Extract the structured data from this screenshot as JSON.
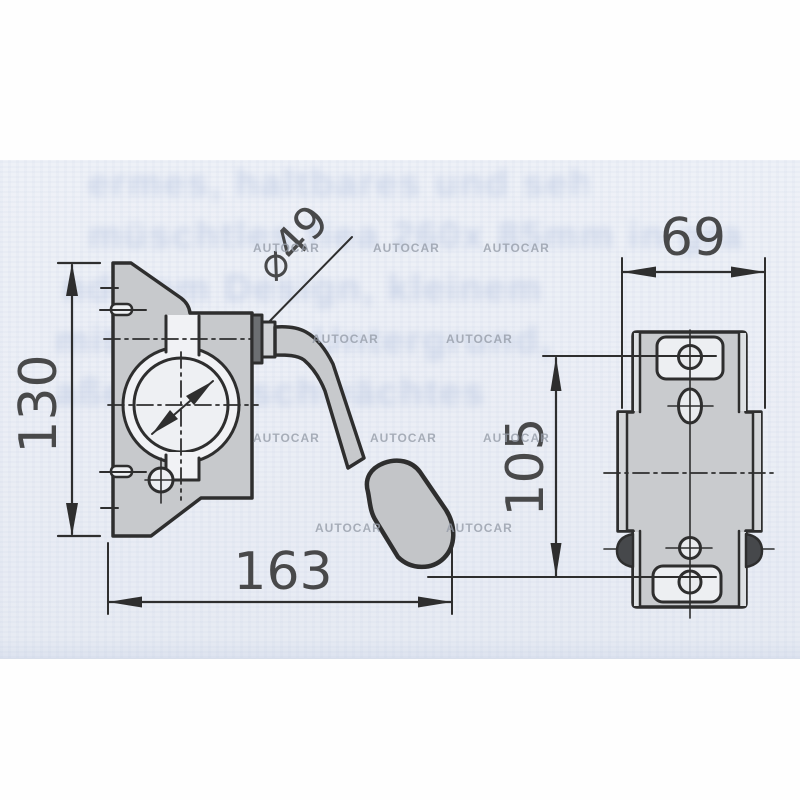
{
  "dims": {
    "left_height": "130",
    "bottom_width": "163",
    "clamp_diameter": "⌀49",
    "right_width": "69",
    "right_hole_spacing": "105"
  },
  "watermark": {
    "label": "AUTOCAR",
    "color": "#959ca8"
  },
  "ghost_text": {
    "lines": [
      "ermes, haltbares und sehr langlei",
      "müschtles fiea 260x 85mm in gra",
      "nderem Design, kleinem Unterba",
      "mit stabilem Untergrund, prakti",
      "aße ohne schwächtes Profil"
    ]
  },
  "colors": {
    "line": "#2e2e2e",
    "part_fill": "#c7c9cc",
    "paper_band": "#edf0f6",
    "watermark": "#959ca8",
    "ghost_text": "#9db0d6"
  }
}
